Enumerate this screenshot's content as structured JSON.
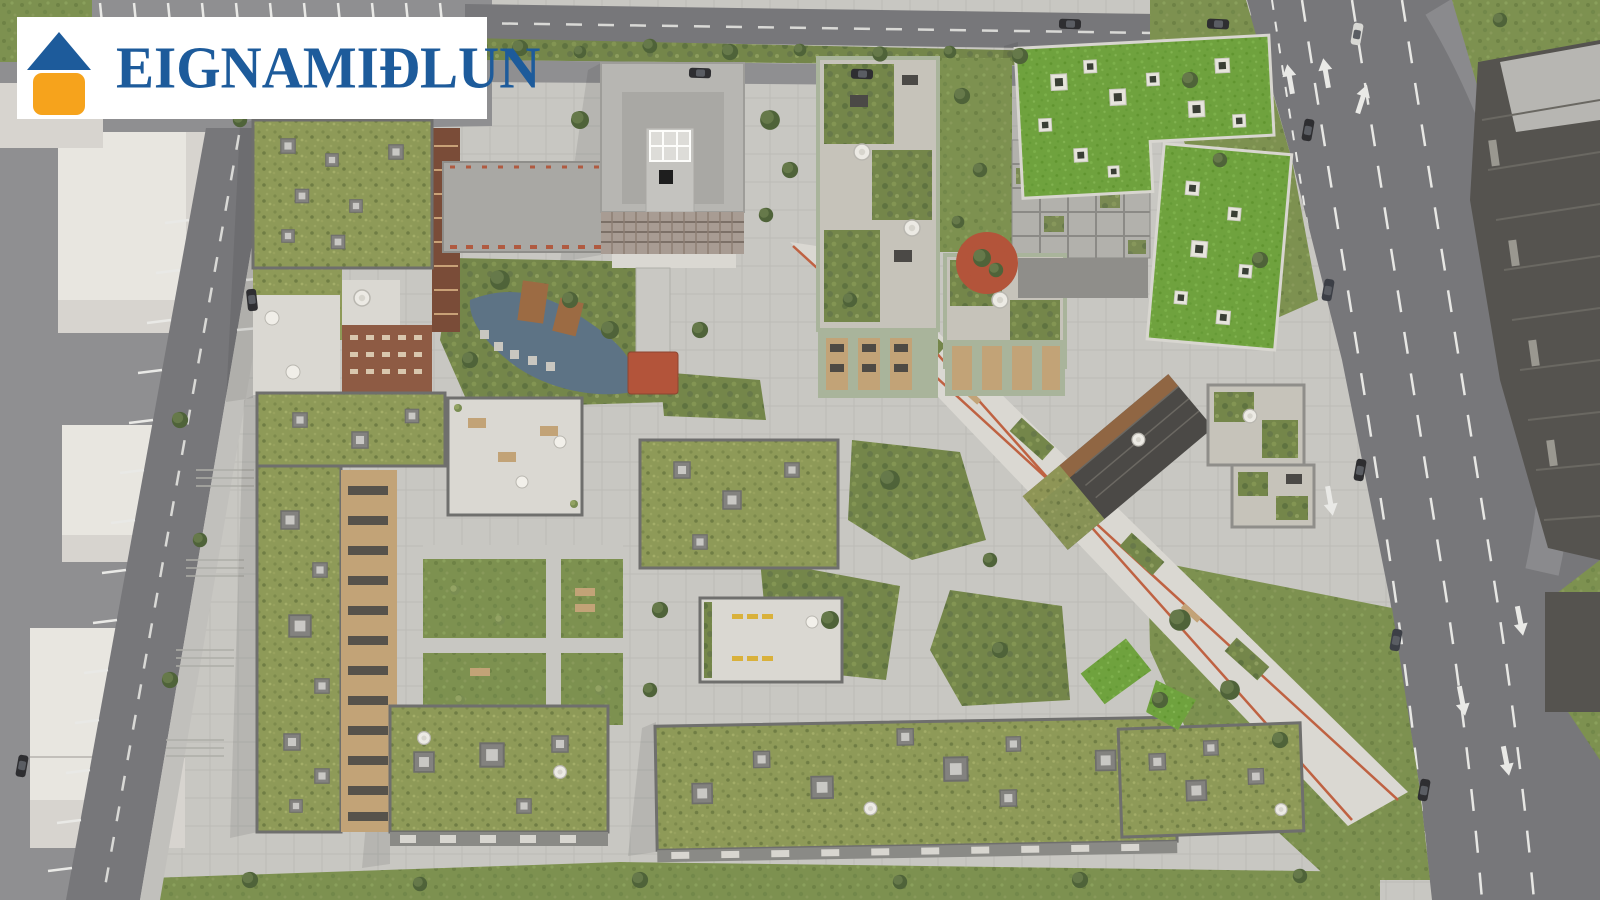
{
  "logo": {
    "brand": "EIGNAMIÐLUN",
    "icon": "house-icon",
    "colors": {
      "logoBlue": "#1d5b9b",
      "logoOrange": "#f6a31c",
      "logoBg": "#ffffff"
    }
  },
  "scene": {
    "description": "Aerial architectural rendering of a residential development block with sedum green roofs, roof terraces, courtyards, a pedestrian boulevard and surrounding streets",
    "palette": {
      "paving": "#c8c7c2",
      "pavingLight": "#dad8d2",
      "asphalt": "#77777a",
      "asphaltLot": "#8f8f91",
      "sidewalk": "#c1c0bc",
      "grassPark": "#7d9150",
      "grassWild": "#74864a",
      "roofSedum": "#8e9a58",
      "roofBright": "#6fa23e",
      "roofGray": "#b7b6b2",
      "roofGrayIn": "#a9a8a4",
      "ghost": "#d7d4cf",
      "ghostTop": "#e8e6e0",
      "brick": "#8e5b44",
      "brickDark": "#7a4c38",
      "mint": "#a9b49b",
      "wood": "#c2a377",
      "woodDark": "#9c6b43",
      "darkBldg": "#4b4946",
      "darkBldg2": "#55534f",
      "terracotta": "#b3543a",
      "blvdLine": "#bf6242",
      "water": "#5d7385",
      "lineWhite": "#e9e9e6",
      "treeDark": "#4f6339",
      "treeLight": "#66794a",
      "parapet": "#6f6f6d",
      "car": "#2e2e31"
    }
  }
}
